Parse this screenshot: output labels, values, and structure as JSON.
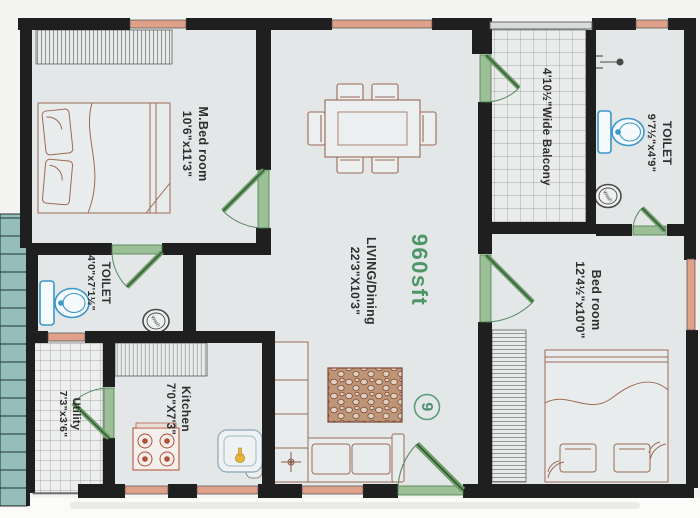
{
  "plan": {
    "title": "House floor plan",
    "area_label": "960sft",
    "rooms": {
      "master_bedroom": {
        "name": "M.Bed room",
        "dims": "10'6\"x11'3\""
      },
      "living": {
        "name": "LIVING/Dining",
        "dims": "22'3\"X10'3\""
      },
      "toilet_attached": {
        "name": "TOILET",
        "dims": "4'0\"x7'1½\""
      },
      "toilet_common": {
        "name": "TOILET",
        "dims": "9'7½\"x4'9\""
      },
      "balcony": {
        "name": "4'10½\"Wide Balcony"
      },
      "bedroom": {
        "name": "Bed room",
        "dims": "12'4½\"x10'0\""
      },
      "kitchen": {
        "name": "Kitchen",
        "dims": "7'0\"X7'3\""
      },
      "utility": {
        "name": "Utility",
        "dims": "7'3\"x3'6\""
      }
    },
    "badges": {
      "door_number": "9"
    },
    "fixtures": {
      "wash": "Wash"
    },
    "colors": {
      "wall": "#1f1f1f",
      "window": "#dfa18a",
      "door_green": "#9bc097",
      "floor": "#e3e7e8",
      "stairs_teal": "#95bdb9",
      "fixture_blue": "#3b97c9",
      "area_green": "#4e9668",
      "furniture_brown": "#9b6a55"
    }
  }
}
